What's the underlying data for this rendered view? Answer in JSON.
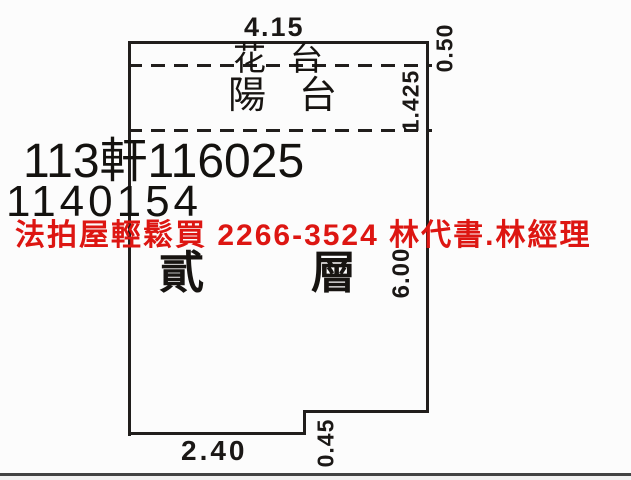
{
  "colors": {
    "ink": "#211e1c",
    "watermark_red": "#dd1612",
    "paper": "#fcfcfc"
  },
  "case_numbers": {
    "line1": "113軒116025",
    "line2": "1140154"
  },
  "watermark": {
    "text": "法拍屋輕鬆買  2266-3524  林代書.林經理"
  },
  "floorplan": {
    "room_label": "貳層",
    "areas": {
      "flower_bed": "花台",
      "balcony": "陽台"
    },
    "dimensions": {
      "top_width": "4.15",
      "flower_bed_depth": "0.50",
      "balcony_depth": "1.425",
      "right_height": "6.00",
      "bottom_width": "2.40",
      "notch_depth": "0.45"
    }
  }
}
